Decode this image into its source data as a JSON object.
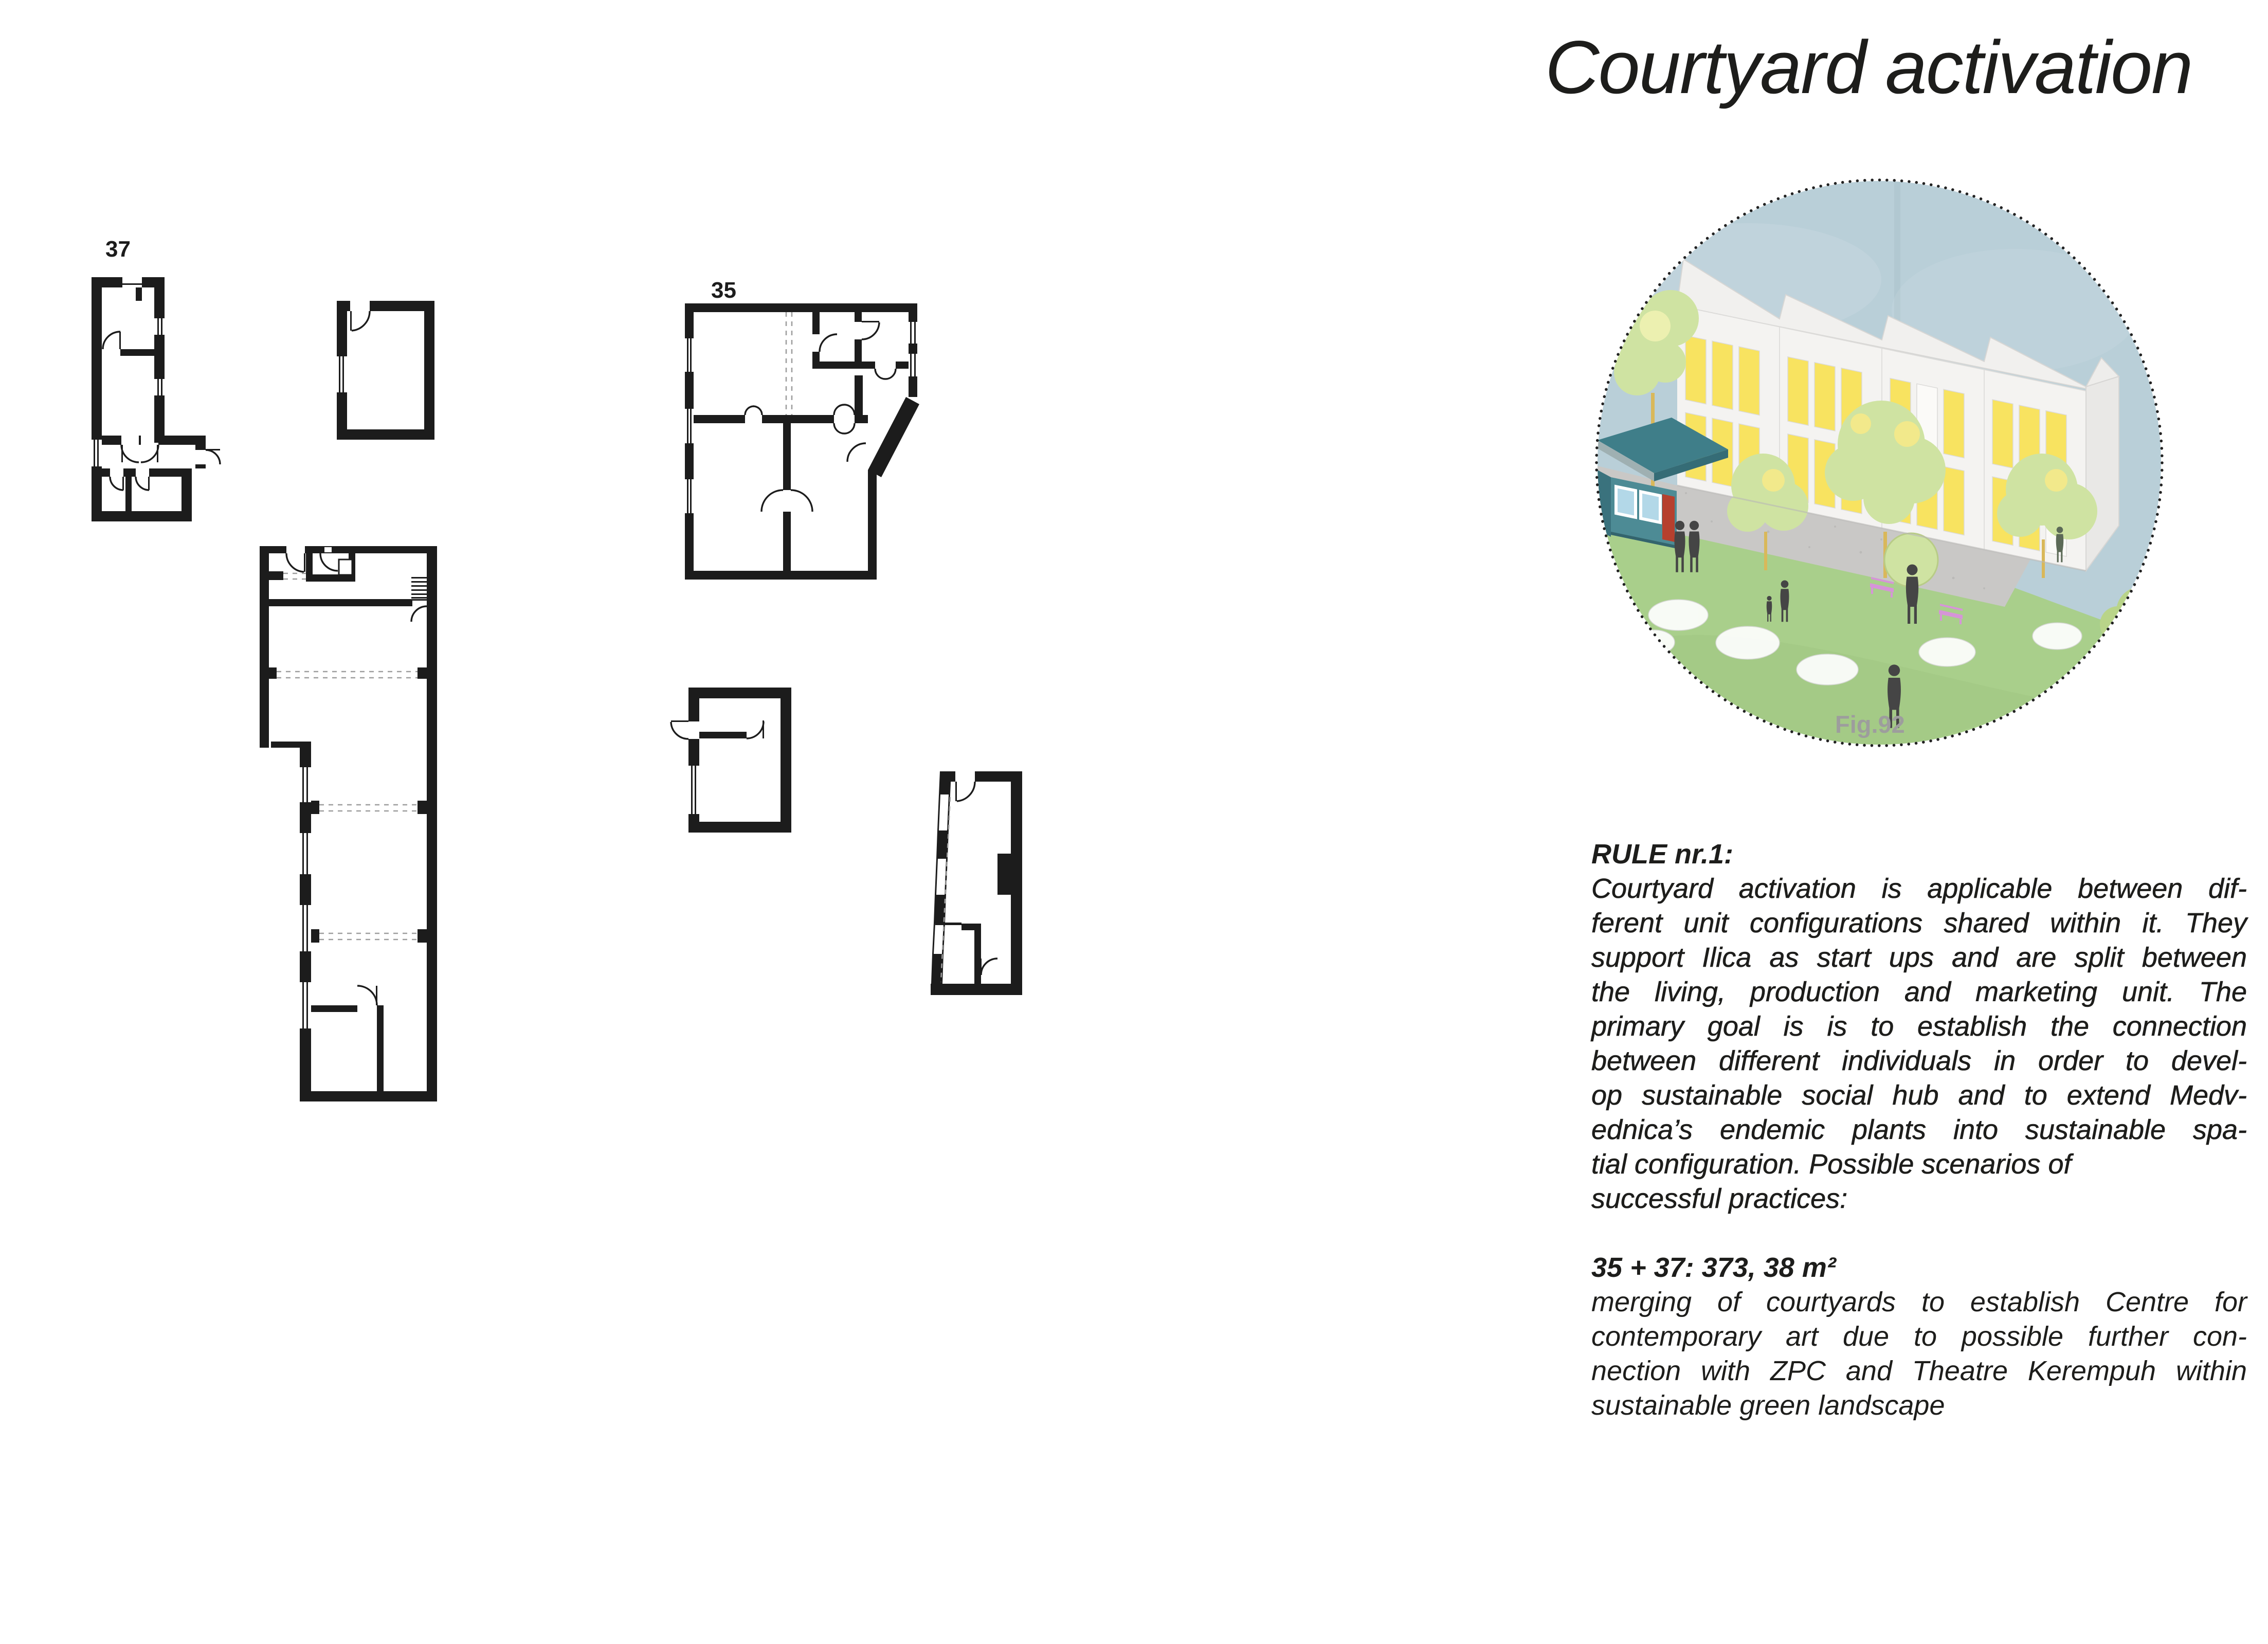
{
  "title": "Courtyard activation",
  "plans": {
    "ink": "#1c1c1c",
    "unit_37_label": "37",
    "unit_35_label": "35"
  },
  "figure": {
    "caption": "Fig.92",
    "colors": {
      "sky": "#b9cfd8",
      "grass": "#a9cf8b",
      "pavement": "#c9c8c6",
      "building": "#f4f3f1",
      "building_side": "#e9e8e6",
      "window_yellow": "#f8e360",
      "kiosk_teal": "#4d8b95",
      "kiosk_roof": "#3f7e89",
      "kiosk_door_red": "#b6402e",
      "kiosk_window_blue": "#b3d8e8",
      "bench_pink": "#d694d8",
      "tree_green": "#cfe3a2",
      "people_gray": "#454545",
      "caption_gray": "#9d9d9d",
      "border_dots": "#222222"
    }
  },
  "rule": {
    "heading": "RULE nr.1:",
    "body_lines": [
      {
        "text": "Courtyard activation is applicable between dif-",
        "justify": true
      },
      {
        "text": "ferent unit configurations shared within it. They",
        "justify": true
      },
      {
        "text": "support Ilica as start ups and are split between",
        "justify": true
      },
      {
        "text": "the living, production and marketing unit. The",
        "justify": true
      },
      {
        "text": "primary goal is is to establish the connection",
        "justify": true
      },
      {
        "text": "between different individuals in order to devel-",
        "justify": true
      },
      {
        "text": "op sustainable social hub and to extend Medv-",
        "justify": true
      },
      {
        "text": "ednica’s endemic plants into sustainable spa-",
        "justify": true
      },
      {
        "text": "tial configuration. Possible scenarios of",
        "justify": false
      },
      {
        "text": "successful practices:",
        "justify": false
      }
    ],
    "area_line": "35 + 37: 373, 38 m²",
    "description_lines": [
      {
        "text": "merging of courtyards to establish Centre for",
        "justify": true
      },
      {
        "text": "contemporary art due to possible further con-",
        "justify": true
      },
      {
        "text": "nection with ZPC and Theatre Kerempuh within",
        "justify": true
      },
      {
        "text": "sustainable green landscape",
        "justify": false
      }
    ]
  }
}
